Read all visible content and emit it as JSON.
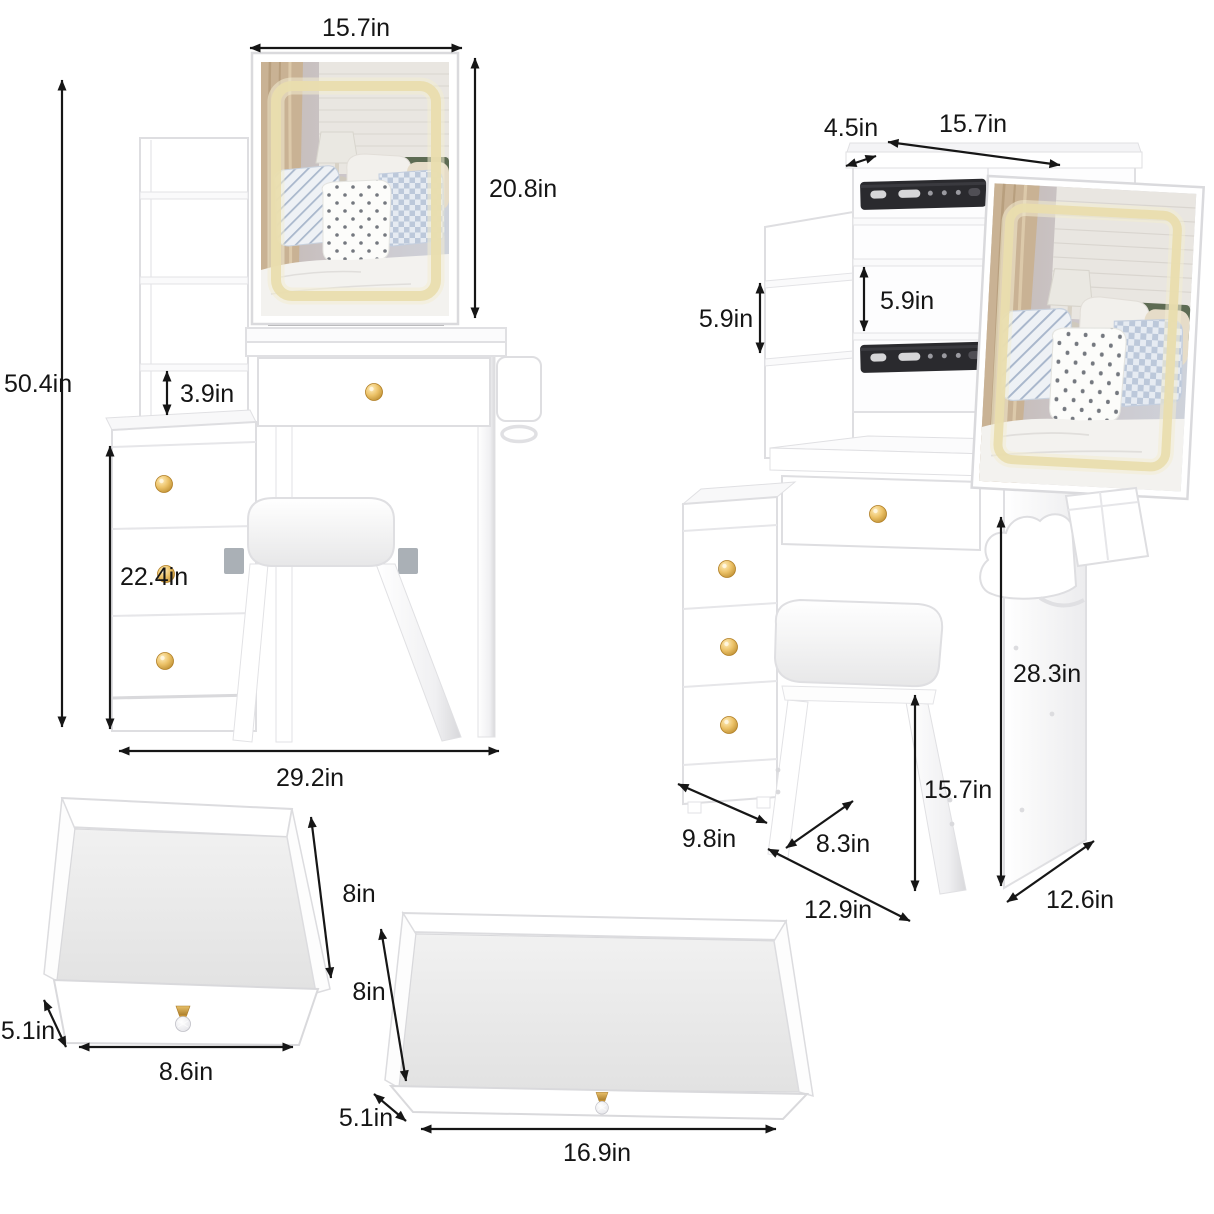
{
  "left_vanity": {
    "dims": {
      "mirror_width": "15.7in",
      "mirror_height": "20.8in",
      "overall_height": "50.4in",
      "shelf_gap": "3.9in",
      "side_cabinet_height": "22.4in",
      "overall_width": "29.2in"
    }
  },
  "right_vanity": {
    "dims": {
      "top_shelf_depth": "4.5in",
      "sliding_mirror_width": "15.7in",
      "left_shelf_spacing": "5.9in",
      "middle_shelf_spacing": "5.9in",
      "desk_height": "28.3in",
      "stool_height": "15.7in",
      "cabinet_depth": "9.8in",
      "stool_depth": "8.3in",
      "knee_space_width": "12.9in",
      "desktop_depth": "12.6in"
    }
  },
  "small_drawer": {
    "dims": {
      "depth": "8in",
      "height": "5.1in",
      "width": "8.6in"
    }
  },
  "wide_drawer": {
    "dims": {
      "depth": "8in",
      "height": "5.1in",
      "width": "16.9in"
    }
  },
  "colors": {
    "background": "#ffffff",
    "annotation": "#151515",
    "furniture_outline": "#dedee1",
    "led_strip": "#e9ddae",
    "knob_gold": "#d9a43c",
    "slide_rail": "#2a2a2e",
    "bracket_gray": "#aab0b6",
    "mirror_curtain": "#c9b294",
    "mirror_headboard": "#5d6b53"
  }
}
